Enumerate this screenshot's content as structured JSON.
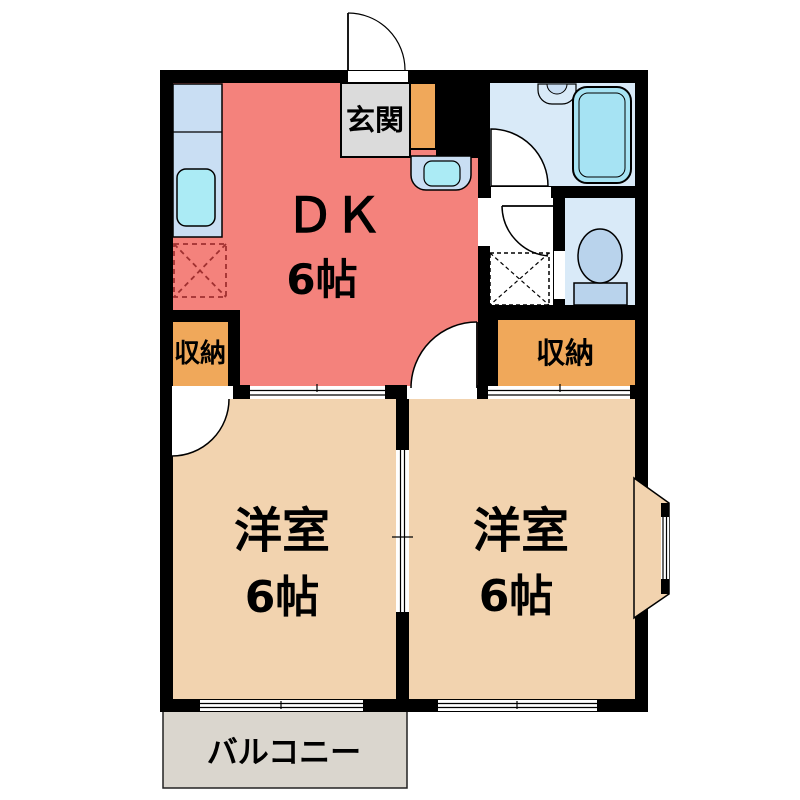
{
  "plan": {
    "entrance": {
      "label": "玄関"
    },
    "dk": {
      "label": "ＤＫ",
      "size": "6帖"
    },
    "storage_left": {
      "label": "収納"
    },
    "storage_right": {
      "label": "収納"
    },
    "room_left": {
      "label": "洋室",
      "size": "6帖"
    },
    "room_right": {
      "label": "洋室",
      "size": "6帖"
    },
    "balcony": {
      "label": "バルコニー"
    }
  },
  "colors": {
    "wall": "#000000",
    "white": "#FFFFFF",
    "dk": "#F4827C",
    "room": "#F2D3AF",
    "storage": "#F0A85A",
    "bath": "#D9EAF8",
    "bathtub": "#A6E3F3",
    "counter": "#C9DEF3",
    "sink": "#ABEBF5",
    "entrance_floor": "#DBDBDB",
    "balcony_floor": "#DAD6CE",
    "toilet": "#B9D3EC",
    "appliance_dash": "#A03030"
  }
}
